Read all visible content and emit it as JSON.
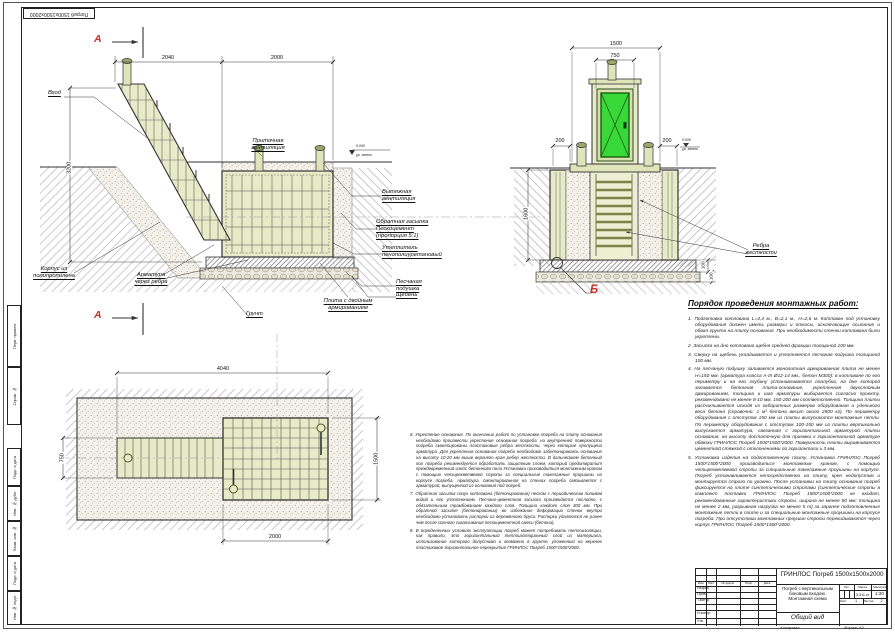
{
  "corner_stamp": "Погреб 1500х1500х2000",
  "edge_column": {
    "top_cells": [
      "Перв. примен.",
      "Справ. №"
    ],
    "bottom_cells": [
      "Подп. и дата",
      "Инв. № дубл.",
      "Взам. инв. №",
      "Подп. и дата",
      "Инв. № подл."
    ]
  },
  "section_a": {
    "marker": "А",
    "dims": {
      "top_left": "2040",
      "top_right": "2000",
      "left": "3200",
      "level": "0.000",
      "level_note": "ур. земли"
    },
    "labels": {
      "entry": "Вход",
      "supply_vent": "Приточная\nвентиляция",
      "exhaust_vent": "Вытяжная\nвентиляция",
      "backfill": "Обратная засыпка\nПескоцемент\n(пропорция 5:1)",
      "insulation": "Утеплитель\nпенополиуретановый",
      "sand_bed": "Песчаная\nподушка",
      "gravel": "Щебень",
      "slab": "Плита с двойным\nармированием",
      "body": "Корпус из\nполипропилена",
      "rebar": "Арматура\nчерез ребра",
      "soil": "Грунт"
    }
  },
  "section_b": {
    "marker": "Б",
    "dims": {
      "width": "1500",
      "door": "750",
      "offset_left": "200",
      "offset_right": "200",
      "depth": "1600",
      "slab": "100",
      "bed": "100",
      "level": "0.000",
      "level_note": "ур. земли"
    },
    "labels": {
      "ribs": "Ребра\nжесткости"
    }
  },
  "plan": {
    "dims": {
      "length": "4040",
      "entry_width": "750",
      "width": "1500",
      "cellar_length": "2000"
    }
  },
  "work_order": {
    "title": "Порядок проведения монтажных работ:",
    "items": [
      "1. Подготовка котлована L=4,4 м., В=2,1 м., Н=2,6 м. Котлован под установку оборудования должен иметь размеры и откосы, исключающие осыпание и обвал грунта на плиту основания. При необходимости стенки котлована были укреплены.",
      "2. Засыпка на дно котлована щебня средней фракции толщиной 100 мм.",
      "3. Сверху на щебень укладывается и уплотняется песчаная подушка толщиной 100 мм.",
      "4. На песчаную подушку заливается монолитная армированная плита не менее Н=150 мм. (арматура класса  А-III Ø12-14 мм., бетон М300): в котловане по его периметру и на его глубину устанавливается опалубка, на дне которой заливается бетонная плита-основание, укрепленная двухслойным армированием, толщина и шаг арматуры выбирается согласно проекту, рекомендовано не менее 8-10 мм, 150-200 мм соответственно. Толщина плиты рассчитывается исходя из габаритных размеров оборудования и удельного веса бетона (справочно: 1 м³ бетона весит около 2500 кг). По периметру оборудования с отступом 150 мм из плиты выпускаются монтажные петли. По периметру оборудования с отступом 100-150 мм из плиты вертикально выпускается арматура, связанная с горизонтальной арматурой плиты основания, на высоту достаточную для приемки к горизонтальной арматуре обвязки ГРИНЛОС Погреб 1500*1500*2000. Поверхность плиты выравнивается цементной стяжкой с  отклонениями по горизонтали ± 3 мм.",
      "5. Установка изделия на подготовленную плиту. Установка ГРИНЛОС Погреб 1500*1500*2000 производиться монтажным краном, с помощью четырехветвевой стропы за специальные такелажные проушины на корпусе. Погреб устанавливается непосредственно на плиту, крен недопустим и монтируется строго по уровню. После установки на плиту основания погреб фиксируется на плите синтетическими стропами (синтетические стропы в комплект поставки ГРИНЛОС Погреб 1500*1500*2000 не входят, рекомендованные характеристики стропы: ширина не менее 50 мм; толщина не менее 2 мм, разрывная нагрузка не менее 5 т) за заранее подготовленные монтажные петли в плите и за специальные монтажные проушины на корпусе погреба. При отсутствии монтажных проушин стропы перекидываются через корпус ГРИНЛОС Погреб 1500*1500*2000."
    ]
  },
  "notes": {
    "items": [
      "6. Укрепление основания. По окончании работ по установке погреба на плиту основания необходимо произвести укрепление основания погреба: на внутренней поверхности погреба смонтированы пластиковые ребра жесткости, через которые пропущена арматура. Для укрепления основания погреба необходимо забетонировать основание на высоту 10-20 мм выше верхнего края ребер жесткости. В дальнейшем бетонный пол погреба рекомендуется обработать защитным слоем, который предотвратит преждевременный износ бетонного пола Установка производиться монтажным краном с помощью четырехветвевой стропы за специальные такелажные проушины на корпусе погреба. Арматура, смонтированная на стенах погреба связывается с арматурой, выпущенной из основания под погреб.",
      "7. Обратная засыпка пазух котлована (бетонирование) песком с периодическим поливом водой и его уплотнением. Песчано-цементная засыпка производится послойно, с обязательным трамбованием каждого слоя. Толщина каждого слоя 300 мм. При обратной засыпке (бетонировании) во избежание деформации стенок внутри необходимо установить распорки из деревянного бруса. Распорки удаляются не ранее чем после полного схватывания пескоцементной смеси (бетона).",
      "8. В определенных условиях эксплуатации погреб может потребовать теплоизоляции, как правило, это горизонтальный теплоизоляционный слой из материала, использование которого допустимо и возможно в грунте, уложенный на верхнее пластиковое горизонтальное перекрытие ГРИНЛОС Погреб 1500*1500*2000."
    ]
  },
  "title_block": {
    "doc_title": "ГРИНЛОС Погреб 1500х1500х2000",
    "doc_name": "Погреб с вертикальным\nбоковым входом.\nМонтажная схема",
    "view_name": "Общий вид",
    "cols": {
      "izm": "Изм.",
      "list": "Лист",
      "doc": "№ докум.",
      "podp": "Подп.",
      "data": "Дата"
    },
    "rows": {
      "razrab": "Разраб.",
      "prov": "Пров.",
      "tkontr": "Т.контр.",
      "nkontr": "Н.контр.",
      "utv": "Утв."
    },
    "stats": {
      "lit": "Лит.",
      "massa": "Масса",
      "masshtab": "Масштаб",
      "massa_value": "3,311 кг",
      "scale_value": "1:20",
      "list_label": "Лист",
      "list_value": "1",
      "listov_label": "Листов",
      "listov_value": "2"
    },
    "footer": {
      "copy": "Копировал",
      "format": "Формат A3"
    }
  },
  "colors": {
    "accent_red": "#c3332b",
    "pale_green": "#e7ebc7",
    "door_green": "#38d838"
  }
}
